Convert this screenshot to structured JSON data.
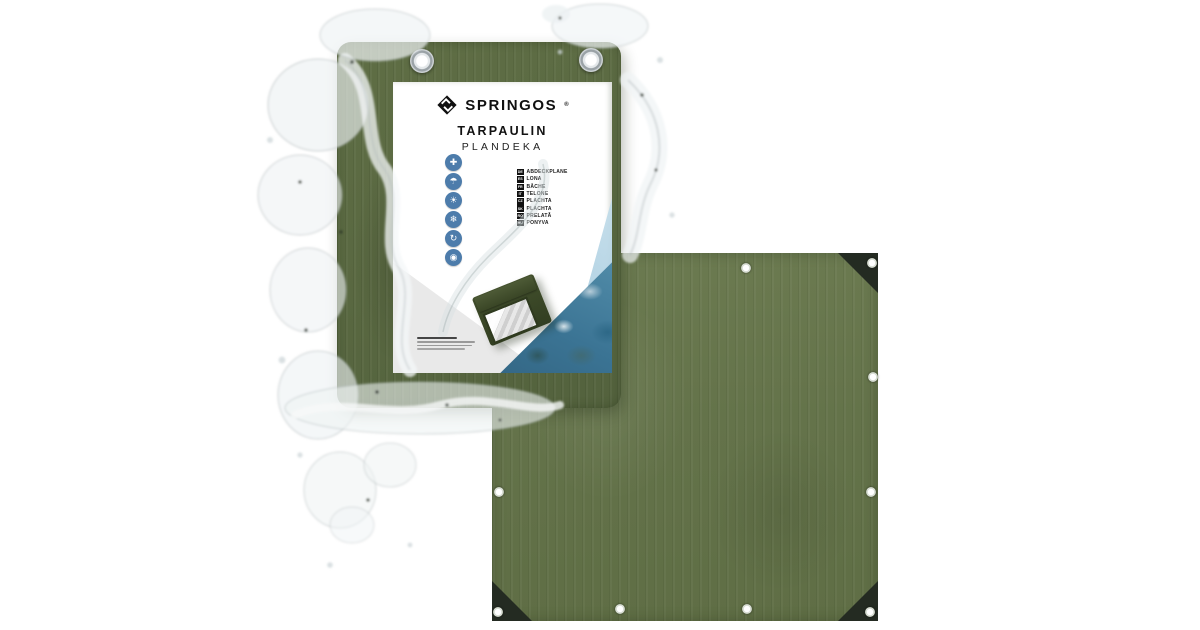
{
  "page": {
    "background": "#ffffff",
    "description_texts": {}
  },
  "brand": {
    "name": "SPRINGOS",
    "registered_mark": "®"
  },
  "label": {
    "title": "TARPAULIN",
    "subtitle": "PLANDEKA",
    "features": [
      {
        "name": "dimensions",
        "glyph": "✚"
      },
      {
        "name": "waterproof",
        "glyph": "☂"
      },
      {
        "name": "uv-protection",
        "glyph": "☀"
      },
      {
        "name": "frost-resistant",
        "glyph": "❄"
      },
      {
        "name": "reusable",
        "glyph": "↻"
      },
      {
        "name": "eyelets",
        "glyph": "◉"
      }
    ],
    "languages": [
      {
        "code": "DE",
        "word": "ABDECKPLANE"
      },
      {
        "code": "ES",
        "word": "LONA"
      },
      {
        "code": "FR",
        "word": "BÂCHE"
      },
      {
        "code": "IT",
        "word": "TELONE"
      },
      {
        "code": "CZ",
        "word": "PLACHTA"
      },
      {
        "code": "SK",
        "word": "PLACHTA"
      },
      {
        "code": "RO",
        "word": "PRELATĂ"
      },
      {
        "code": "HU",
        "word": "PONYVA"
      }
    ]
  },
  "colors": {
    "tarp_green": "#64734A",
    "package_green": "#596841",
    "corner_black": "#242B22",
    "icon_blue": "#4D7CAB",
    "water_teal": "#3B7494",
    "label_white": "#FFFFFF",
    "grommet_metal": "#9AA2A6"
  }
}
